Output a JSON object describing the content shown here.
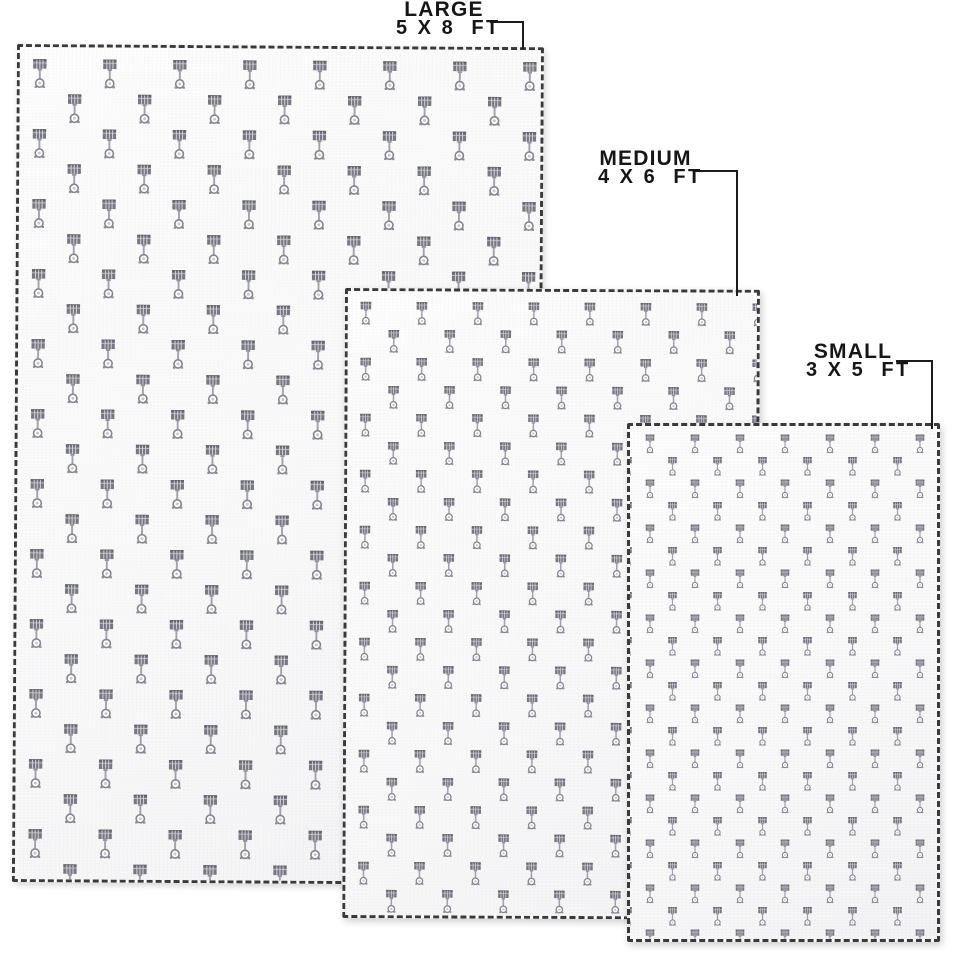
{
  "product": {
    "pattern_icon": "piston-icon",
    "pattern_color": "#75757f",
    "rug_fill_color": "#fbfbfc",
    "stitch_edge_color": "#3a3a3a",
    "label_color": "#161616"
  },
  "sizes": [
    {
      "name": "LARGE",
      "dimensions": "5 X 8  FT"
    },
    {
      "name": "MEDIUM",
      "dimensions": "4 X 6  FT"
    },
    {
      "name": "SMALL",
      "dimensions": "3 X 5  FT"
    }
  ]
}
